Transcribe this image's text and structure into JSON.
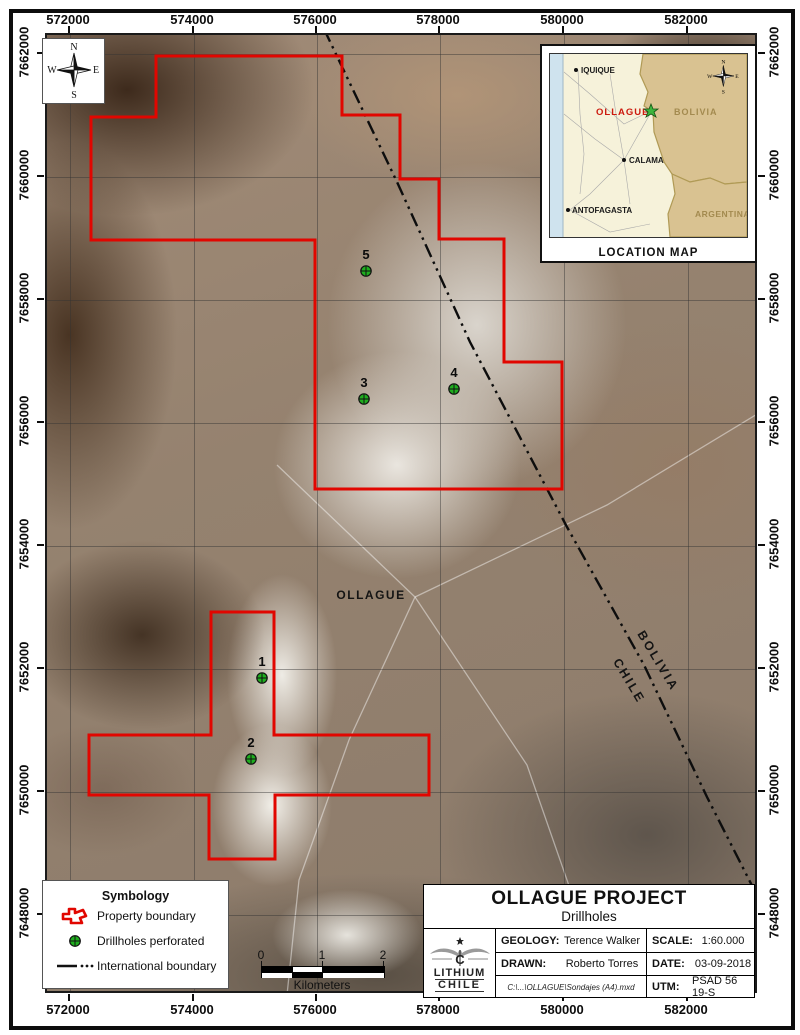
{
  "frame": {
    "top_labels": [
      "572000",
      "574000",
      "576000",
      "578000",
      "580000",
      "582000"
    ],
    "bottom_labels": [
      "572000",
      "574000",
      "576000",
      "578000",
      "580000",
      "582000"
    ],
    "left_labels": [
      "7662000",
      "7660000",
      "7658000",
      "7656000",
      "7654000",
      "7652000",
      "7650000",
      "7648000"
    ],
    "right_labels": [
      "7662000",
      "7660000",
      "7658000",
      "7656000",
      "7654000",
      "7652000",
      "7650000",
      "7648000"
    ]
  },
  "compass": {
    "n": "N",
    "e": "E",
    "s": "S",
    "w": "W"
  },
  "map": {
    "town_label": "OLLAGUE",
    "country_left": "CHILE",
    "country_right": "BOLIVIA",
    "drillholes": [
      {
        "id": "1"
      },
      {
        "id": "2"
      },
      {
        "id": "3"
      },
      {
        "id": "4"
      },
      {
        "id": "5"
      }
    ]
  },
  "inset": {
    "caption": "LOCATION MAP",
    "labels": {
      "iquique": "IQUIQUE",
      "ollague": "OLLAGUE",
      "calama": "CALAMA",
      "antofagasta": "ANTOFAGASTA",
      "bolivia": "BOLIVIA",
      "argentina": "ARGENTINA"
    },
    "compass": {
      "n": "N",
      "e": "E",
      "s": "S",
      "w": "W"
    }
  },
  "legend": {
    "title": "Symbology",
    "items": [
      {
        "label": "Property boundary"
      },
      {
        "label": "Drillholes perforated"
      },
      {
        "label": "International boundary"
      }
    ]
  },
  "scalebar": {
    "ticks": [
      "0",
      "1",
      "2"
    ],
    "unit": "Kilometers"
  },
  "titleblock": {
    "title": "OLLAGUE PROJECT",
    "subtitle": "Drillholes",
    "logo_line1": "LITHIUM",
    "logo_line2": "CHILE",
    "fields": {
      "geology_key": "GEOLOGY:",
      "geology_val": "Terence Walker",
      "drawn_key": "DRAWN:",
      "drawn_val": "Roberto Torres",
      "scale_key": "SCALE:",
      "scale_val": "1:60.000",
      "date_key": "DATE:",
      "date_val": "03-09-2018",
      "utm_key": "UTM:",
      "utm_val": "PSAD 56 19-S",
      "path": "C:\\...\\OLLAGUE\\Sondajes (A4).mxd"
    }
  },
  "colors": {
    "property_boundary": "#e10600",
    "drillhole_green": "#1fae1f",
    "international_boundary": "#0d0d0d",
    "inset_highlight_red": "#cc1a0e"
  }
}
